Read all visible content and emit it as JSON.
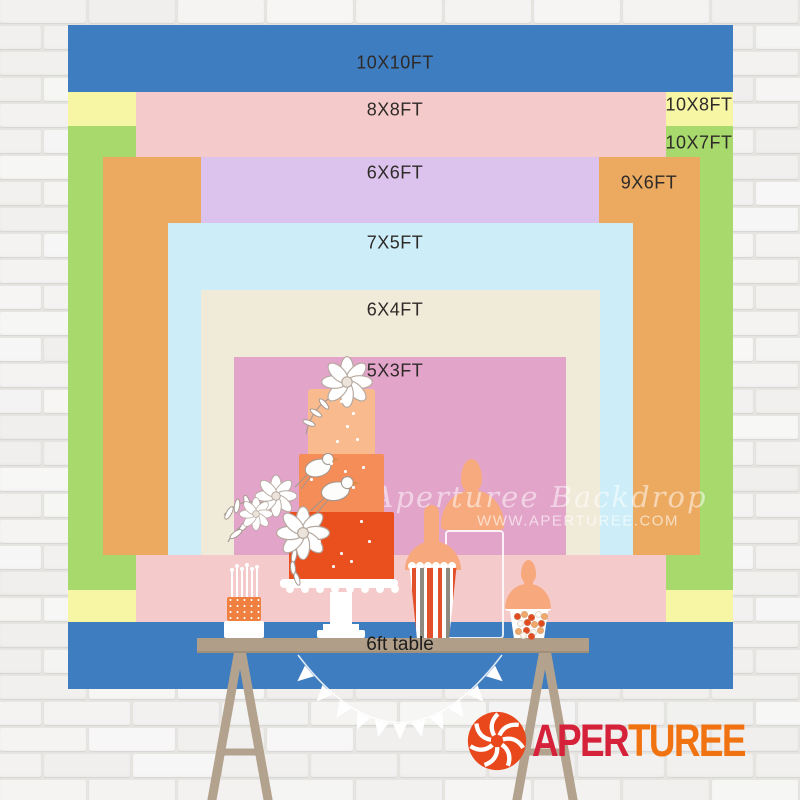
{
  "sizes": [
    {
      "label": "10X10FT",
      "color": "#3f7dc1"
    },
    {
      "label": "8X8FT",
      "color": "#f5caca"
    },
    {
      "label": "10X8FT",
      "color": "#f7f6a5"
    },
    {
      "label": "10X7FT",
      "color": "#a7d96c"
    },
    {
      "label": "6X6FT",
      "color": "#dcc3ed"
    },
    {
      "label": "9X6FT",
      "color": "#ecaa60"
    },
    {
      "label": "7X5FT",
      "color": "#cdeef8"
    },
    {
      "label": "6X4FT",
      "color": "#f0ead9"
    },
    {
      "label": "5X3FT",
      "color": "#e2a4c9"
    }
  ],
  "table_label": "6ft table",
  "watermark": {
    "script": "Aperturee Backdrop",
    "site": "WWW.APERTUREE.COM"
  },
  "logo": {
    "red_part": "APER",
    "orange_part": "TUREE",
    "red": "#d6213a",
    "orange": "#f17210",
    "icon_color": "#e8481c"
  }
}
